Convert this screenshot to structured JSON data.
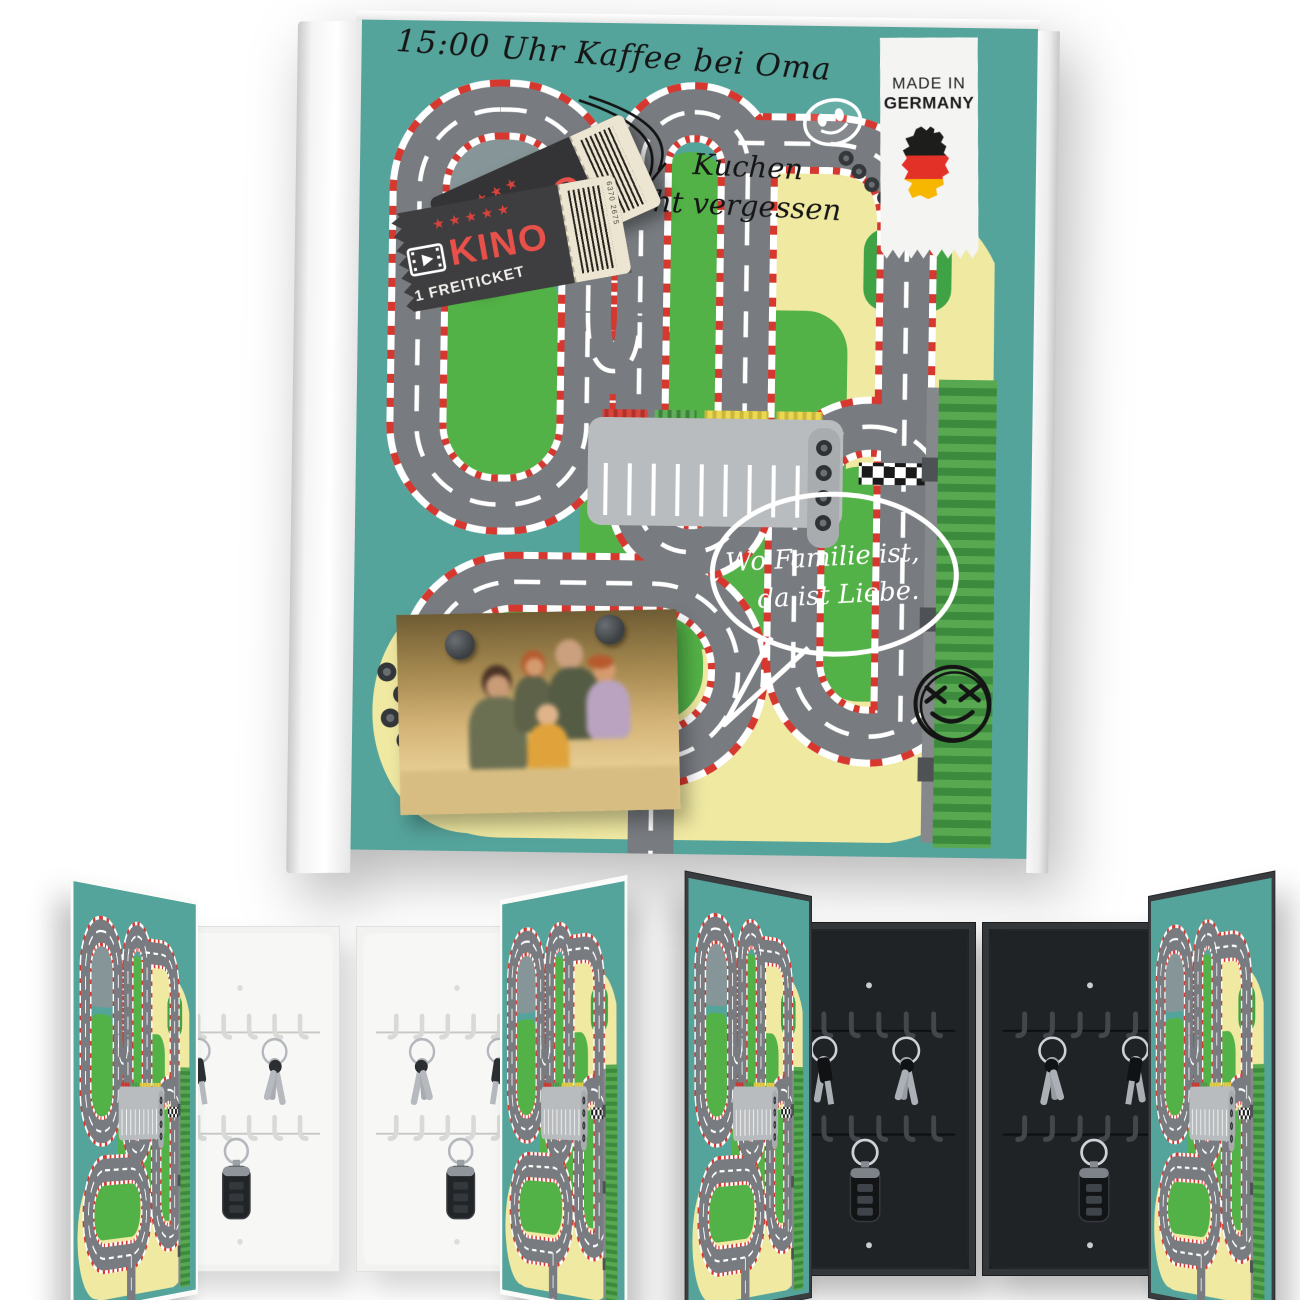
{
  "hero": {
    "handwriting": {
      "appointment_note": "15:00 Uhr Kaffee bei Oma",
      "reminder_line1": "Kuchen",
      "reminder_line2": "nicht vergessen",
      "quote_line1": "Wo Familie ist,",
      "quote_line2": "da ist Liebe."
    },
    "badge": {
      "line1": "MADE IN",
      "line2": "GERMANY"
    },
    "ticket": {
      "title": "KINO",
      "subtitle": "1 FREITICKET",
      "stars_front": "★★★★★",
      "stars_back": "★★★★",
      "back_letter": "O",
      "barcode_number": "6370 2675"
    },
    "colors": {
      "teal": "#55a49c",
      "pale_yellow": "#f0e9a2",
      "grass_green": "#53b247",
      "dark_green": "#3fa244",
      "road_gray": "#787c80",
      "curb_red": "#d6382f",
      "ticket_dark": "#3e3d3f",
      "ticket_cream": "#ece5d1",
      "ticket_red": "#e8504a",
      "germany_black": "#1d1d1b",
      "germany_red": "#e33127",
      "germany_gold": "#f7b600"
    },
    "icons": [
      "smiley-icon",
      "x-smiley-icon",
      "tires-icon",
      "germany-map-icon",
      "film-reel-icon",
      "barcode",
      "magnet",
      "speech-bubble",
      "arrow-doodle"
    ]
  },
  "gallery": {
    "items": [
      {
        "variant": "white",
        "door_side": "left"
      },
      {
        "variant": "white",
        "door_side": "right"
      },
      {
        "variant": "black",
        "door_side": "left"
      },
      {
        "variant": "black",
        "door_side": "right"
      }
    ]
  }
}
